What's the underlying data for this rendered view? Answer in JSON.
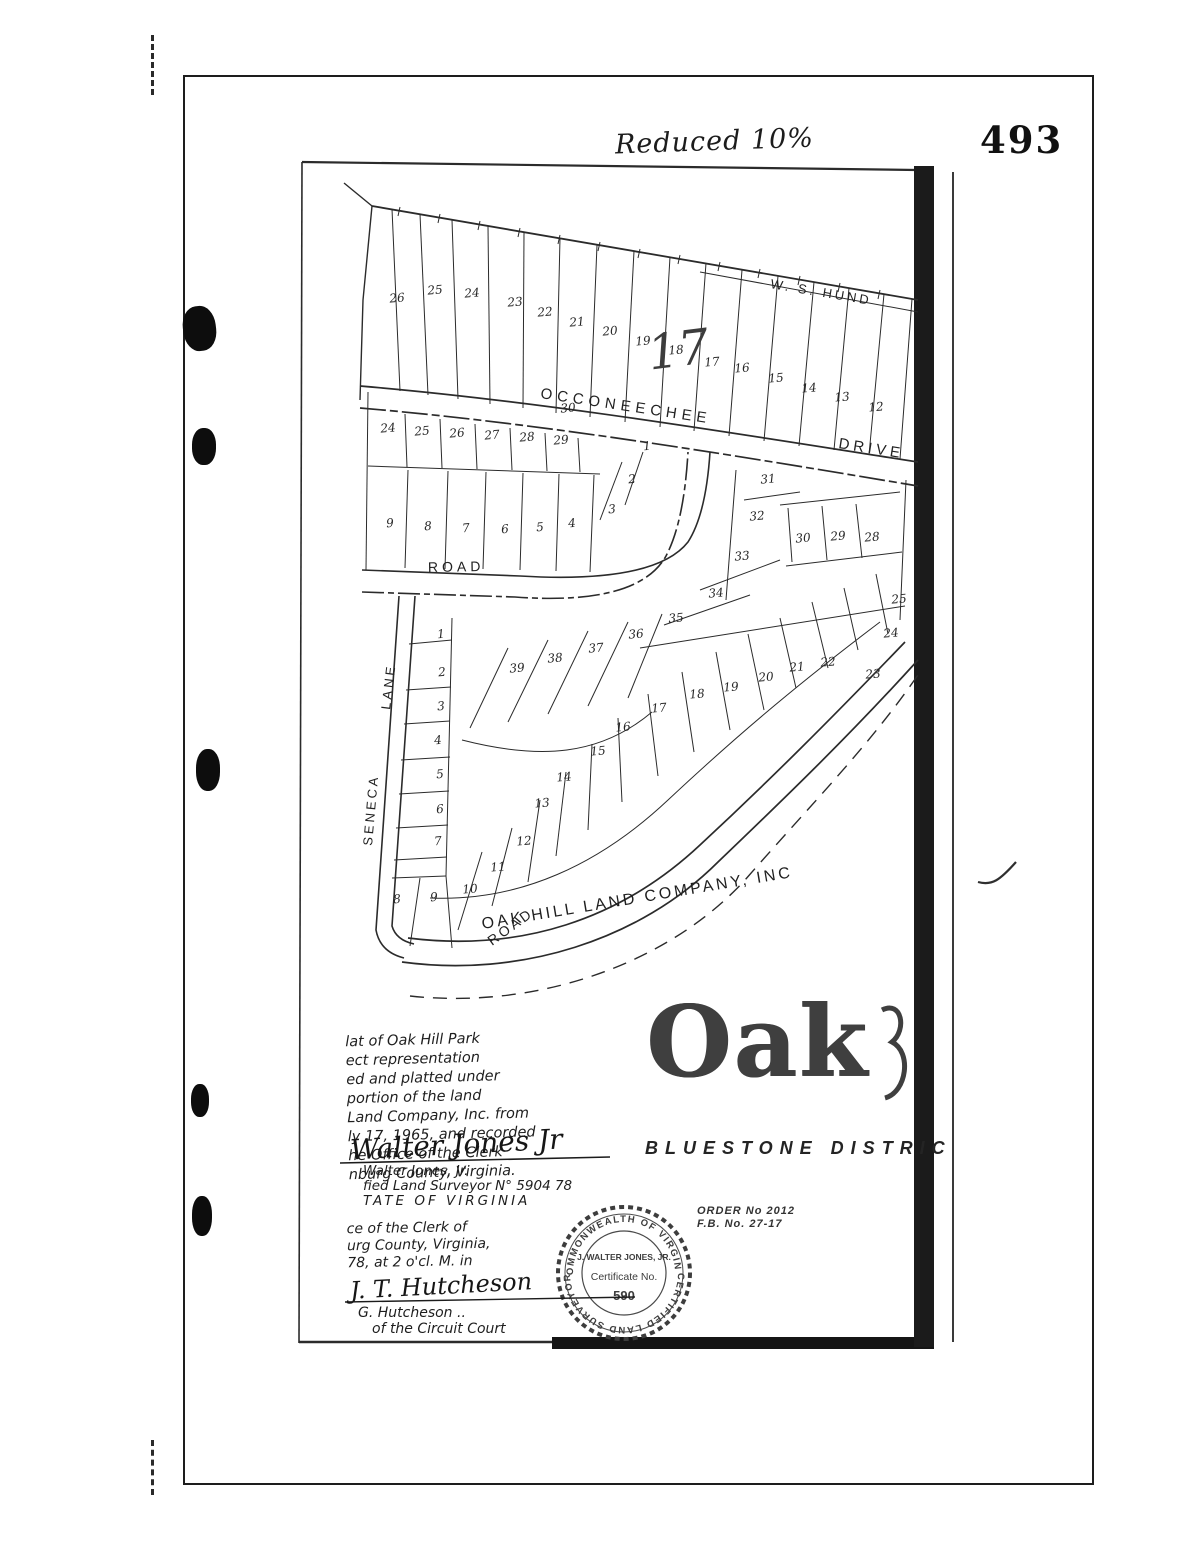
{
  "page": {
    "number": "493",
    "handwritten_note": "Reduced 10%"
  },
  "map": {
    "adjacent_owner": "W. S. HUND",
    "pencil_annotation": "17",
    "company_label": "OAK HILL LAND COMPANY, INC",
    "streets": {
      "occoneechee_name": "OCCONEECHEE",
      "occoneechee_type": "DRIVE",
      "mid_road": "ROAD",
      "seneca_name": "SENECA",
      "seneca_type": "LANE",
      "bottom_road": "ROAD"
    },
    "lots": [
      {
        "n": "26",
        "x": 397,
        "y": 298
      },
      {
        "n": "25",
        "x": 435,
        "y": 290
      },
      {
        "n": "24",
        "x": 472,
        "y": 293
      },
      {
        "n": "23",
        "x": 515,
        "y": 302
      },
      {
        "n": "22",
        "x": 545,
        "y": 312
      },
      {
        "n": "21",
        "x": 577,
        "y": 322
      },
      {
        "n": "20",
        "x": 610,
        "y": 331
      },
      {
        "n": "19",
        "x": 643,
        "y": 341
      },
      {
        "n": "18",
        "x": 676,
        "y": 350
      },
      {
        "n": "17",
        "x": 712,
        "y": 362
      },
      {
        "n": "16",
        "x": 742,
        "y": 368
      },
      {
        "n": "15",
        "x": 776,
        "y": 378
      },
      {
        "n": "14",
        "x": 809,
        "y": 388
      },
      {
        "n": "13",
        "x": 842,
        "y": 397
      },
      {
        "n": "12",
        "x": 876,
        "y": 407
      },
      {
        "n": "24",
        "x": 388,
        "y": 428
      },
      {
        "n": "25",
        "x": 422,
        "y": 431
      },
      {
        "n": "26",
        "x": 457,
        "y": 433
      },
      {
        "n": "27",
        "x": 492,
        "y": 435
      },
      {
        "n": "28",
        "x": 527,
        "y": 437
      },
      {
        "n": "29",
        "x": 561,
        "y": 440
      },
      {
        "n": "30",
        "x": 568,
        "y": 408
      },
      {
        "n": "9",
        "x": 390,
        "y": 523
      },
      {
        "n": "8",
        "x": 428,
        "y": 526
      },
      {
        "n": "7",
        "x": 466,
        "y": 528
      },
      {
        "n": "6",
        "x": 505,
        "y": 529
      },
      {
        "n": "5",
        "x": 540,
        "y": 527
      },
      {
        "n": "4",
        "x": 572,
        "y": 523
      },
      {
        "n": "3",
        "x": 612,
        "y": 509
      },
      {
        "n": "2",
        "x": 632,
        "y": 479
      },
      {
        "n": "1",
        "x": 647,
        "y": 446
      },
      {
        "n": "1",
        "x": 441,
        "y": 634
      },
      {
        "n": "2",
        "x": 442,
        "y": 672
      },
      {
        "n": "3",
        "x": 441,
        "y": 706
      },
      {
        "n": "4",
        "x": 438,
        "y": 740
      },
      {
        "n": "5",
        "x": 440,
        "y": 774
      },
      {
        "n": "6",
        "x": 440,
        "y": 809
      },
      {
        "n": "7",
        "x": 438,
        "y": 841
      },
      {
        "n": "8",
        "x": 397,
        "y": 899
      },
      {
        "n": "9",
        "x": 434,
        "y": 897
      },
      {
        "n": "10",
        "x": 470,
        "y": 889
      },
      {
        "n": "11",
        "x": 498,
        "y": 867
      },
      {
        "n": "12",
        "x": 524,
        "y": 841
      },
      {
        "n": "13",
        "x": 542,
        "y": 803
      },
      {
        "n": "14",
        "x": 564,
        "y": 777
      },
      {
        "n": "15",
        "x": 598,
        "y": 751
      },
      {
        "n": "16",
        "x": 623,
        "y": 727
      },
      {
        "n": "17",
        "x": 659,
        "y": 708
      },
      {
        "n": "18",
        "x": 697,
        "y": 694
      },
      {
        "n": "19",
        "x": 731,
        "y": 687
      },
      {
        "n": "20",
        "x": 766,
        "y": 677
      },
      {
        "n": "21",
        "x": 797,
        "y": 667
      },
      {
        "n": "22",
        "x": 828,
        "y": 662
      },
      {
        "n": "23",
        "x": 873,
        "y": 674
      },
      {
        "n": "24",
        "x": 891,
        "y": 633
      },
      {
        "n": "25",
        "x": 899,
        "y": 599
      },
      {
        "n": "36",
        "x": 636,
        "y": 634
      },
      {
        "n": "37",
        "x": 596,
        "y": 648
      },
      {
        "n": "38",
        "x": 555,
        "y": 658
      },
      {
        "n": "39",
        "x": 517,
        "y": 668
      },
      {
        "n": "35",
        "x": 676,
        "y": 618
      },
      {
        "n": "34",
        "x": 716,
        "y": 593
      },
      {
        "n": "33",
        "x": 742,
        "y": 556
      },
      {
        "n": "32",
        "x": 757,
        "y": 516
      },
      {
        "n": "31",
        "x": 768,
        "y": 479
      },
      {
        "n": "30",
        "x": 803,
        "y": 538
      },
      {
        "n": "29",
        "x": 838,
        "y": 536
      },
      {
        "n": "28",
        "x": 872,
        "y": 537
      }
    ]
  },
  "title_block": {
    "title": "Oak",
    "district": "BLUESTONE DISTRIC",
    "order_no": "ORDER  No 2012",
    "fb_no": "F.B. No. 27-17",
    "description": [
      "lat of Oak Hill Park",
      "ect representation",
      "ed and platted under",
      "portion of the land",
      "Land Company, Inc. from",
      "ly 17, 1965, and recorded",
      "he Office of the Clerk",
      "nburg County, Virginia."
    ],
    "signature": "Walter Jones Jr",
    "surveyor_line1": "Walter Jones, Jr.",
    "surveyor_line2": "fied Land Surveyor N° 5904 78",
    "surveyor_line3": "TATE OF VIRGINIA"
  },
  "clerk_block": {
    "line1": "ce of the Clerk of",
    "line2": "urg County, Virginia,",
    "line3": "78, at 2 o'cl. M. in",
    "signature": "J. T. Hutcheson",
    "line4": "G. Hutcheson ..",
    "line5": "of the Circuit Court"
  },
  "seal": {
    "arc_top": "COMMONWEALTH OF VIRGINIA",
    "arc_bottom": "CERTIFIED LAND SURVEYOR",
    "name": "J. WALTER JONES, JR.",
    "cert_label": "Certificate No.",
    "cert_number": "590"
  }
}
